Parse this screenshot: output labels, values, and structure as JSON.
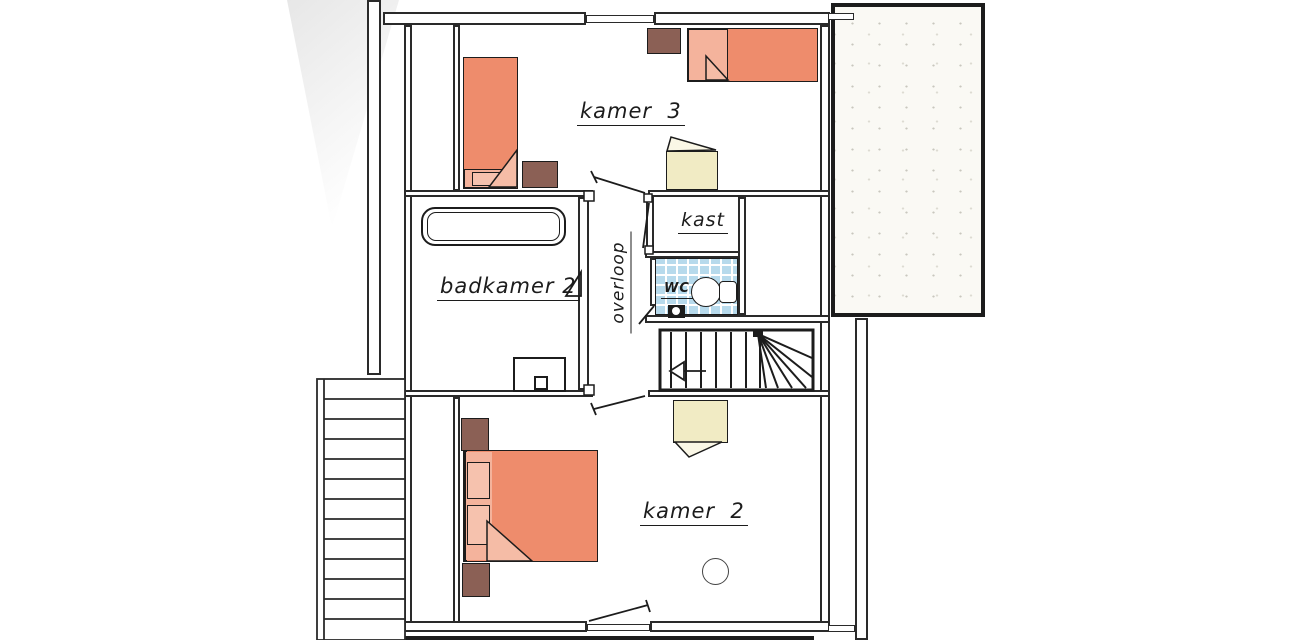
{
  "plan_title": "upper-floor plan",
  "labels": {
    "kamer3": "kamer  3",
    "kast": "kast",
    "overloop": "overloop",
    "badkamer2": "badkamer 2",
    "wc": "WC",
    "kamer2": "kamer  2"
  },
  "colors": {
    "line": "#1c1c1c",
    "bed_salmon": "#ee8c6c",
    "pillow_salmon": "#f4b39c",
    "wood_brown": "#8b6055",
    "chair_cream": "#f1ebc4",
    "wc_tile_blue": "#b7daec",
    "terrace_speckle": "#faf9f4",
    "paper": "#ffffff"
  }
}
